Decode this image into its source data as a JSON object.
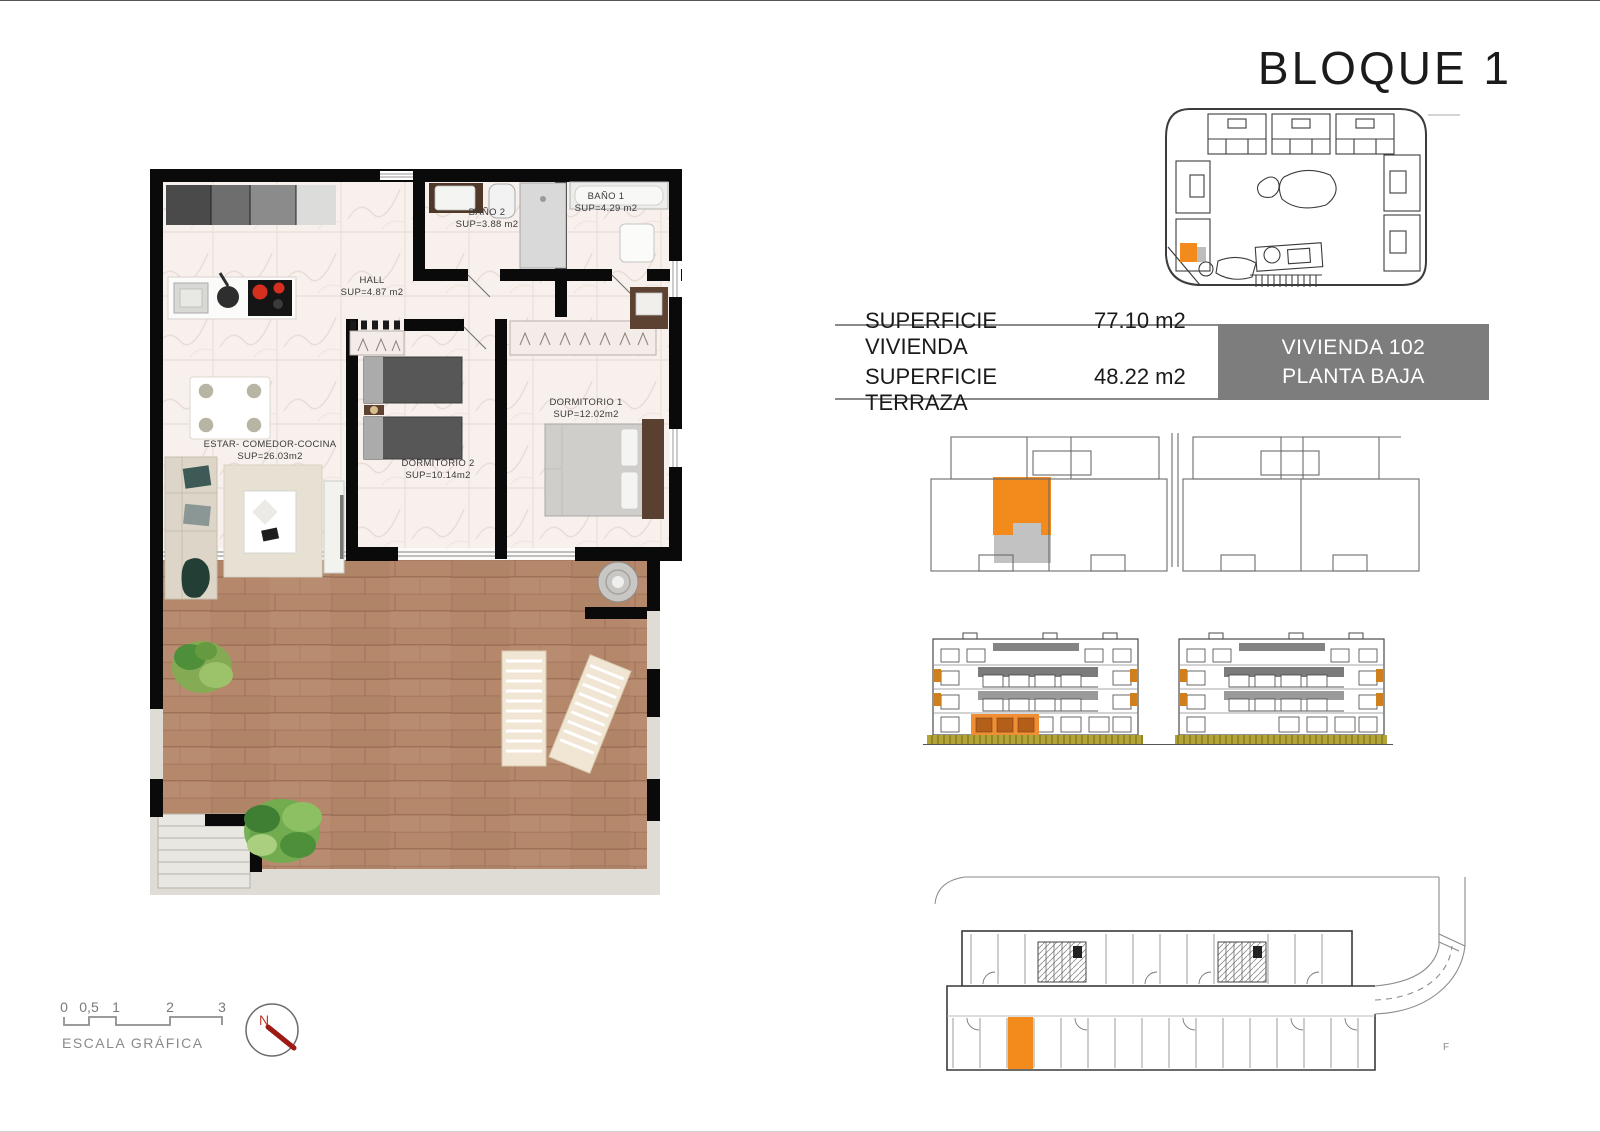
{
  "page": {
    "title": "BLOQUE 1"
  },
  "floor_plan": {
    "rooms": [
      {
        "name": "BAÑO 1",
        "area": "SUP=4.29 m2"
      },
      {
        "name": "BAÑO 2",
        "area": "SUP=3.88 m2"
      },
      {
        "name": "HALL",
        "area": "SUP=4.87 m2"
      },
      {
        "name": "DORMITORIO 1",
        "area": "SUP=12.02m2"
      },
      {
        "name": "DORMITORIO 2",
        "area": "SUP=10.14m2"
      },
      {
        "name": "ESTAR- COMEDOR-COCINA",
        "area": "SUP=26.03m2"
      }
    ]
  },
  "summary": {
    "rows": [
      {
        "label": "SUPERFICIE VIVIENDA",
        "value": "77.10 m2"
      },
      {
        "label": "SUPERFICIE TERRAZA",
        "value": "48.22 m2"
      }
    ],
    "badge": {
      "line1": "VIVIENDA 102",
      "line2": "PLANTA BAJA"
    }
  },
  "scale": {
    "ticks": [
      "0",
      "0,5",
      "1",
      "2",
      "3"
    ],
    "label": "ESCALA GRÁFICA"
  },
  "compass": {
    "north": "N"
  },
  "parking": {
    "corner_mark": "F"
  },
  "colors": {
    "highlight_orange": "#F28A1C",
    "terrace_gray": "#C2C2C2",
    "badge_gray": "#7D7D7D",
    "hedge_olive": "#B3A437",
    "north_red": "#C0392B"
  }
}
